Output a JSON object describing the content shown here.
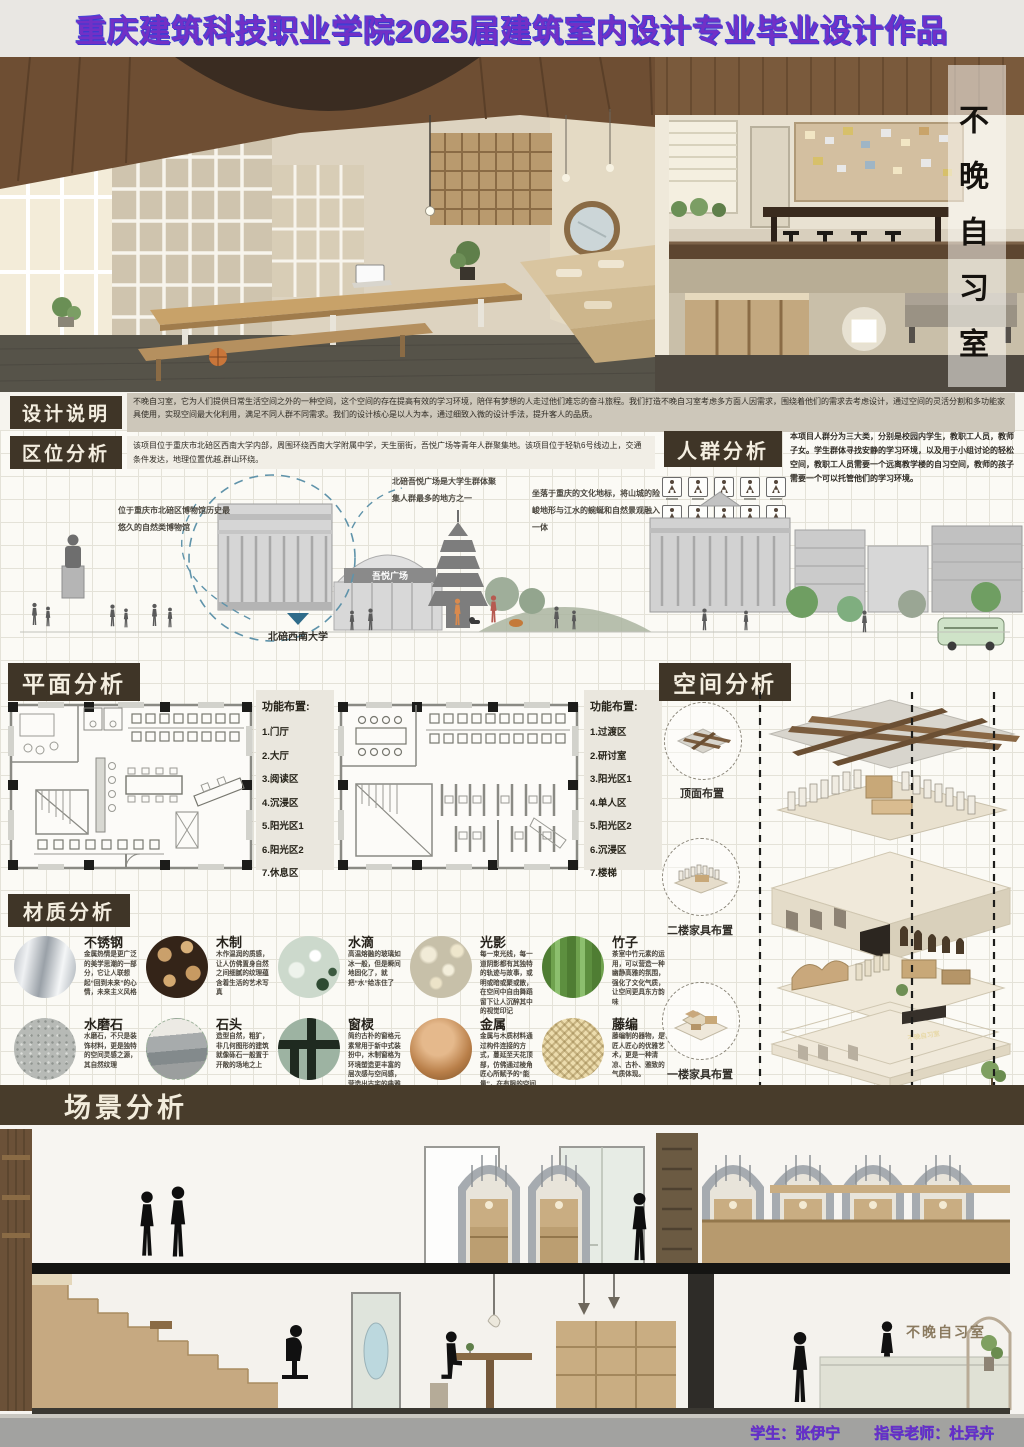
{
  "header": {
    "title": "重庆建筑科技职业学院2025届建筑室内设计专业毕业设计作品"
  },
  "hero": {
    "vertical_title": "不晚自习室"
  },
  "design": {
    "title": "设计说明",
    "text": "不晚自习室，它为人们提供日常生活空间之外的一种空间，这个空间的存在提高有效的学习环境，陪伴有梦想的人走过他们难忘的奋斗旅程。我们打造不晚自习室考虑多方面人因需求，围绕着他们的需求去考虑设计，通过空间的灵活分割和多功能家具使用，实现空间最大化利用，满足不同人群不同需求。我们的设计核心是以人为本，通过细致入微的设计手法，提升客人的品质。"
  },
  "location": {
    "title": "区位分析",
    "text": "该项目位于重庆市北碚区西南大学内部，周围环绕西南大学附属中学，天生丽街，吾悦广场等青年人群聚集地。该项目位于轻轨6号线边上，交通条件发达，地理位置优越,群山环绕。",
    "annotations": [
      "位于重庆市北碚区博物馆历史最悠久的自然类博物馆",
      "北碚吾悦广场是大学生群体聚集人群最多的地方之一",
      "坐落于重庆的文化地标，将山城的险峻地形与江水的蜿蜒和自然景观融入一体"
    ],
    "site_label": "北碚西南大学",
    "mall_sign": "吾悦广场"
  },
  "crowd": {
    "title": "人群分析",
    "text": "本项目人群分为三大类，分别是校园内学生，教职工人员，教师子女。学生群体寻找安静的学习环境，以及用于小组讨论的轻松空间，教职工人员需要一个远离教学楼的自习空间，教师的孩子需要一个可以托管他们的学习环境。"
  },
  "plan": {
    "title": "平面分析",
    "list1": {
      "title": "功能布置:",
      "items": [
        "1.门厅",
        "2.大厅",
        "3.阅读区",
        "4.沉浸区",
        "5.阳光区1",
        "6.阳光区2",
        "7.休息区"
      ]
    },
    "list2": {
      "title": "功能布置:",
      "items": [
        "1.过渡区",
        "2.研讨室",
        "3.阳光区1",
        "4.单人区",
        "5.阳光区2",
        "6.沉浸区",
        "7.楼梯"
      ]
    }
  },
  "space": {
    "title": "空间分析",
    "labels": [
      "顶面布置",
      "二楼家具布置",
      "一楼家具布置"
    ],
    "sign": "不晚自习室"
  },
  "material": {
    "title": "材质分析",
    "items": [
      {
        "name": "不锈钢",
        "desc": "金属热情是更广泛的美学思潮的一部分，它让人联想起“回到未来”的心情，未来主义风格"
      },
      {
        "name": "木制",
        "desc": "木作温润的质感，让人仿佛置身自然之间细腻的纹理蕴含着生活的艺术写真"
      },
      {
        "name": "水滴",
        "desc": "高温熔融的玻璃如冰一般，但是瞬间地固化了，就把“水”给冻住了"
      },
      {
        "name": "光影",
        "desc": "每一束光线，每一道阴影都有其独特的轨迹与故事，或明或暗或聚或散，在空间中自由舞蹈留下让人沉醉其中的视觉印记"
      },
      {
        "name": "竹子",
        "desc": "茶室中竹元素的运用，可以营造一种幽静高雅的氛围，强化了文化气质，让空间更具东方韵味"
      },
      {
        "name": "水磨石",
        "desc": "水磨石，不只是装饰材料，更是独特的空间灵感之源，其自然纹理"
      },
      {
        "name": "石头",
        "desc": "造型自然，粗犷，非几何图形的建筑就像砾石一般置于开敞的场地之上"
      },
      {
        "name": "窗棂",
        "desc": "简约古朴的窗格元素常用于新中式装扮中，木制窗格为环境塑造更丰富的层次感与空间感，营造出古宅的典雅氛围"
      },
      {
        "name": "金属",
        "desc": "金属与木质材料通过构件连接的方式，蔓延至天花顶部，仿佛通过棱角匠心所赋予的“能量”，在有限的空间中，无限生长"
      },
      {
        "name": "藤编",
        "desc": "藤编制的器物，是匠人匠心的优雅艺术，更是一种清凉、古朴、雅致的气质体现。"
      }
    ]
  },
  "scene": {
    "title": "场景分析",
    "sign": "不晚自习室"
  },
  "footer": {
    "student": "学生：张伊宁",
    "advisor": "指导老师：杜异卉"
  },
  "colors": {
    "accent_purple": "#7230c6",
    "panel_brown": "#3f3527",
    "panel_text": "#f4eee0",
    "marker_blue": "#2e6b8a"
  }
}
